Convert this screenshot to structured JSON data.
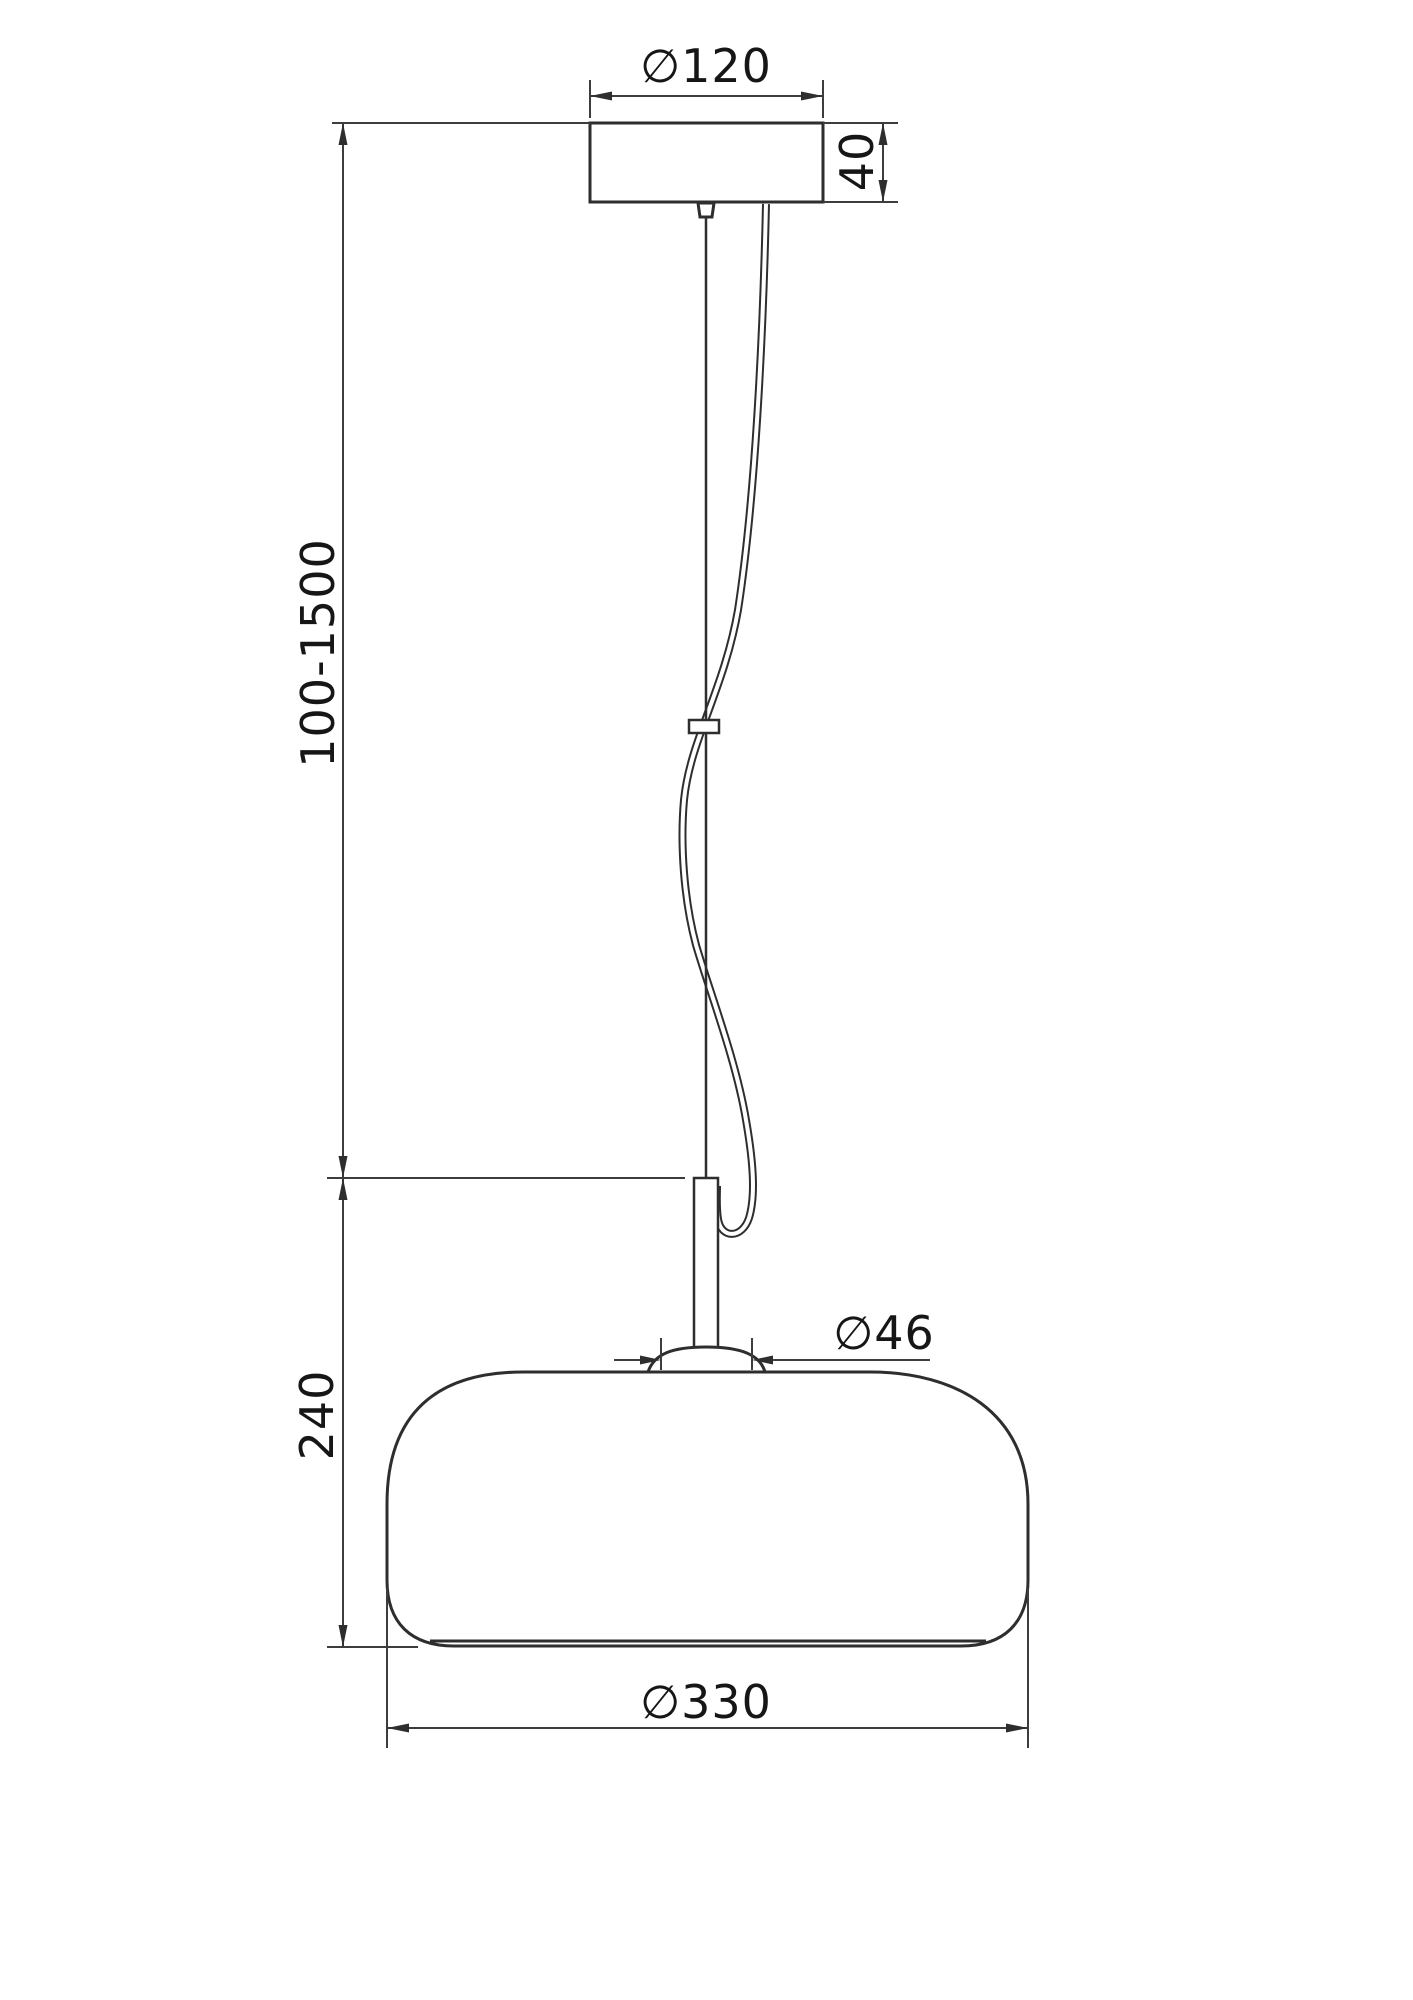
{
  "drawing": {
    "type": "pendant-lamp-technical-drawing",
    "background_color": "#ffffff",
    "line_color": "#2e2e2e",
    "text_color": "#161616",
    "dimensions": {
      "canopy_diameter": "∅120",
      "canopy_height": "40",
      "suspension_range": "100-1500",
      "body_height": "240",
      "socket_diameter": "∅46",
      "shade_diameter": "∅330"
    }
  }
}
